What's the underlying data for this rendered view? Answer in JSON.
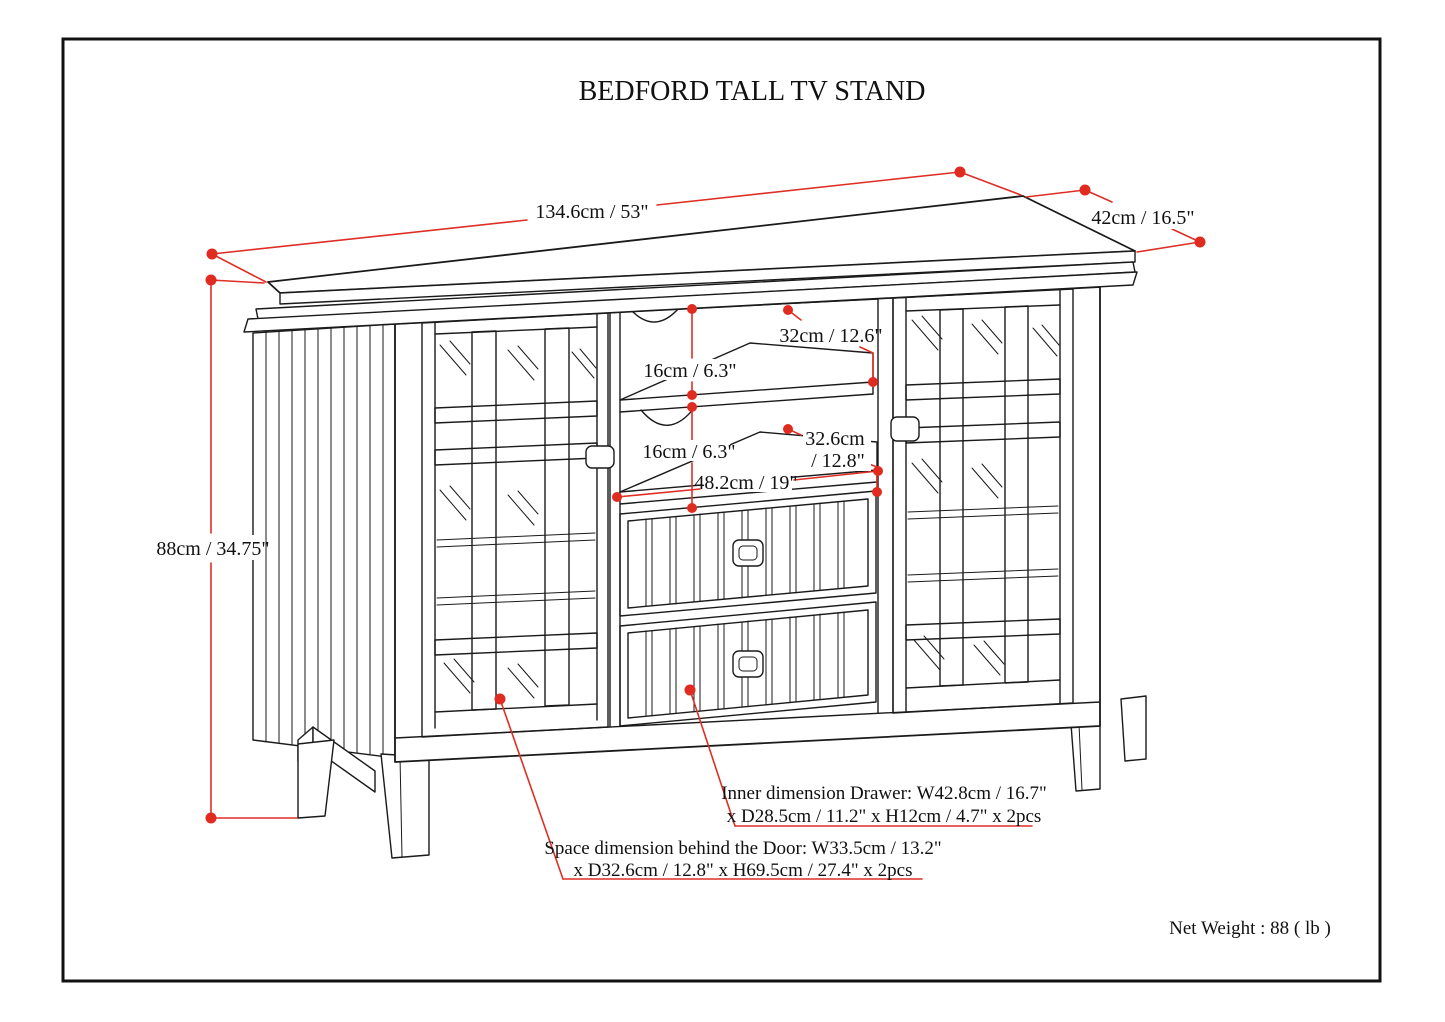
{
  "title": "BEDFORD TALL TV STAND",
  "dims": {
    "width": "134.6cm / 53\"",
    "depth": "42cm / 16.5\"",
    "height": "88cm / 34.75\"",
    "shelf1_height": "16cm / 6.3\"",
    "shelf1_depth": "32cm / 12.6\"",
    "shelf2_height": "16cm / 6.3\"",
    "shelf2_depth_line1": "32.6cm",
    "shelf2_depth_line2": "/ 12.8\"",
    "center_width": "48.2cm / 19\""
  },
  "callouts": {
    "drawer_line1": "Inner dimension Drawer: W42.8cm / 16.7\"",
    "drawer_line2": "x D28.5cm / 11.2\" x H12cm / 4.7\" x 2pcs",
    "door_line1": "Space dimension behind the Door: W33.5cm / 13.2\"",
    "door_line2": "x D32.6cm / 12.8\" x H69.5cm / 27.4\" x 2pcs"
  },
  "net_weight": "Net Weight : 88 ( lb )",
  "colors": {
    "dimension_red": "#de2f26",
    "line_black": "#1a1a1a",
    "background": "#ffffff"
  }
}
